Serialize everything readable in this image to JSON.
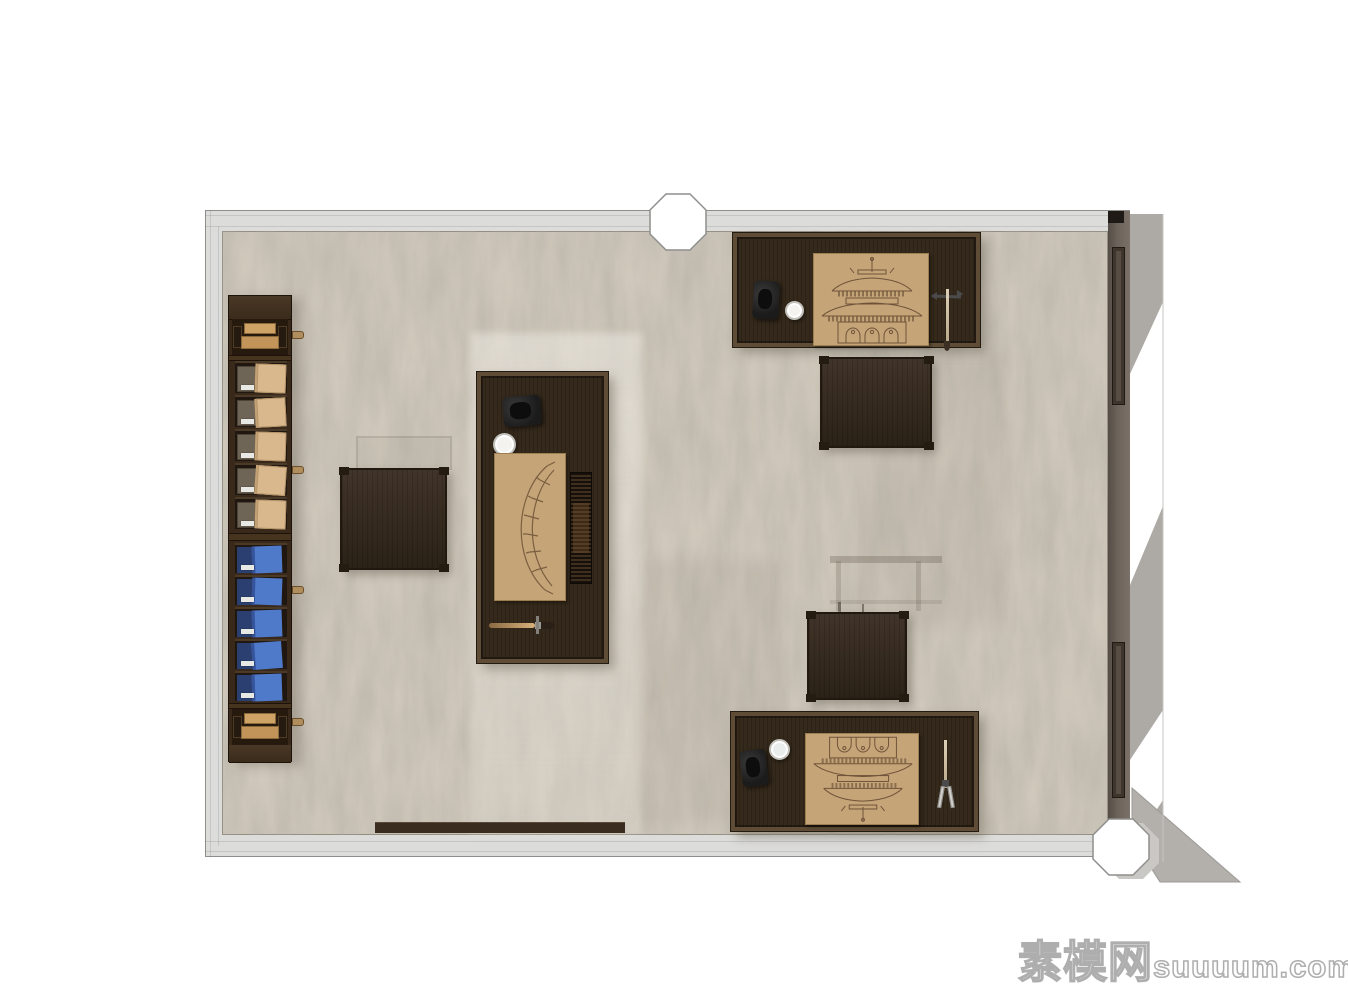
{
  "watermark": {
    "cjk": "素模网",
    "latin": "suuuum.com"
  },
  "palette": {
    "canvas": "#ffffff",
    "wall-light": "#dcdcda",
    "wall-dark": "#6b6259",
    "line-gray": "#8e8e8c",
    "floor": "#cfc8bb",
    "wood-dark": "#35291b",
    "wood-frame": "#5e4c36",
    "paper-tan": "#c5a478",
    "folio-tan": "#d9b88d",
    "box-gray": "#6f6557",
    "box-blue": "#4f79c9",
    "box-blue-dark": "#2b4071",
    "ink-black": "#1b1b1b",
    "shadow-gray": "#adaaa6",
    "drawing-ink": "#6f5339"
  },
  "scene": {
    "view": "top-down interior render",
    "architecture": [
      "light gray perimeter wall (top, left, bottom)",
      "dark right wall with two window slots",
      "octagonal column in top wall",
      "octagonal column at bottom-right corner",
      "light shadow cast through right wall windows"
    ],
    "furniture": [
      {
        "id": "archive-cabinet",
        "contents": [
          "top drawer with tan fronts",
          "5 shelves with gray boxes and tan folios",
          "5 shelves with blue document boxes",
          "bottom drawer with tan fronts"
        ]
      },
      {
        "id": "center-desk",
        "contents": [
          "inkstone",
          "white water cup",
          "tan sheet with arched bridge drawing",
          "bamboo slat scroll",
          "writing brush"
        ]
      },
      {
        "id": "top-right-desk",
        "contents": [
          "inkstone",
          "white water cup",
          "tan sheet with temple elevation drawing",
          "hanging brush stand"
        ]
      },
      {
        "id": "bottom-right-desk",
        "contents": [
          "inkstone",
          "white water cup",
          "tan sheet with temple elevation drawing",
          "divider compass tool"
        ]
      },
      {
        "id": "stool-left"
      },
      {
        "id": "stool-top-right"
      },
      {
        "id": "stool-bottom-right"
      },
      {
        "id": "low-bench-bottom-wall"
      }
    ]
  }
}
